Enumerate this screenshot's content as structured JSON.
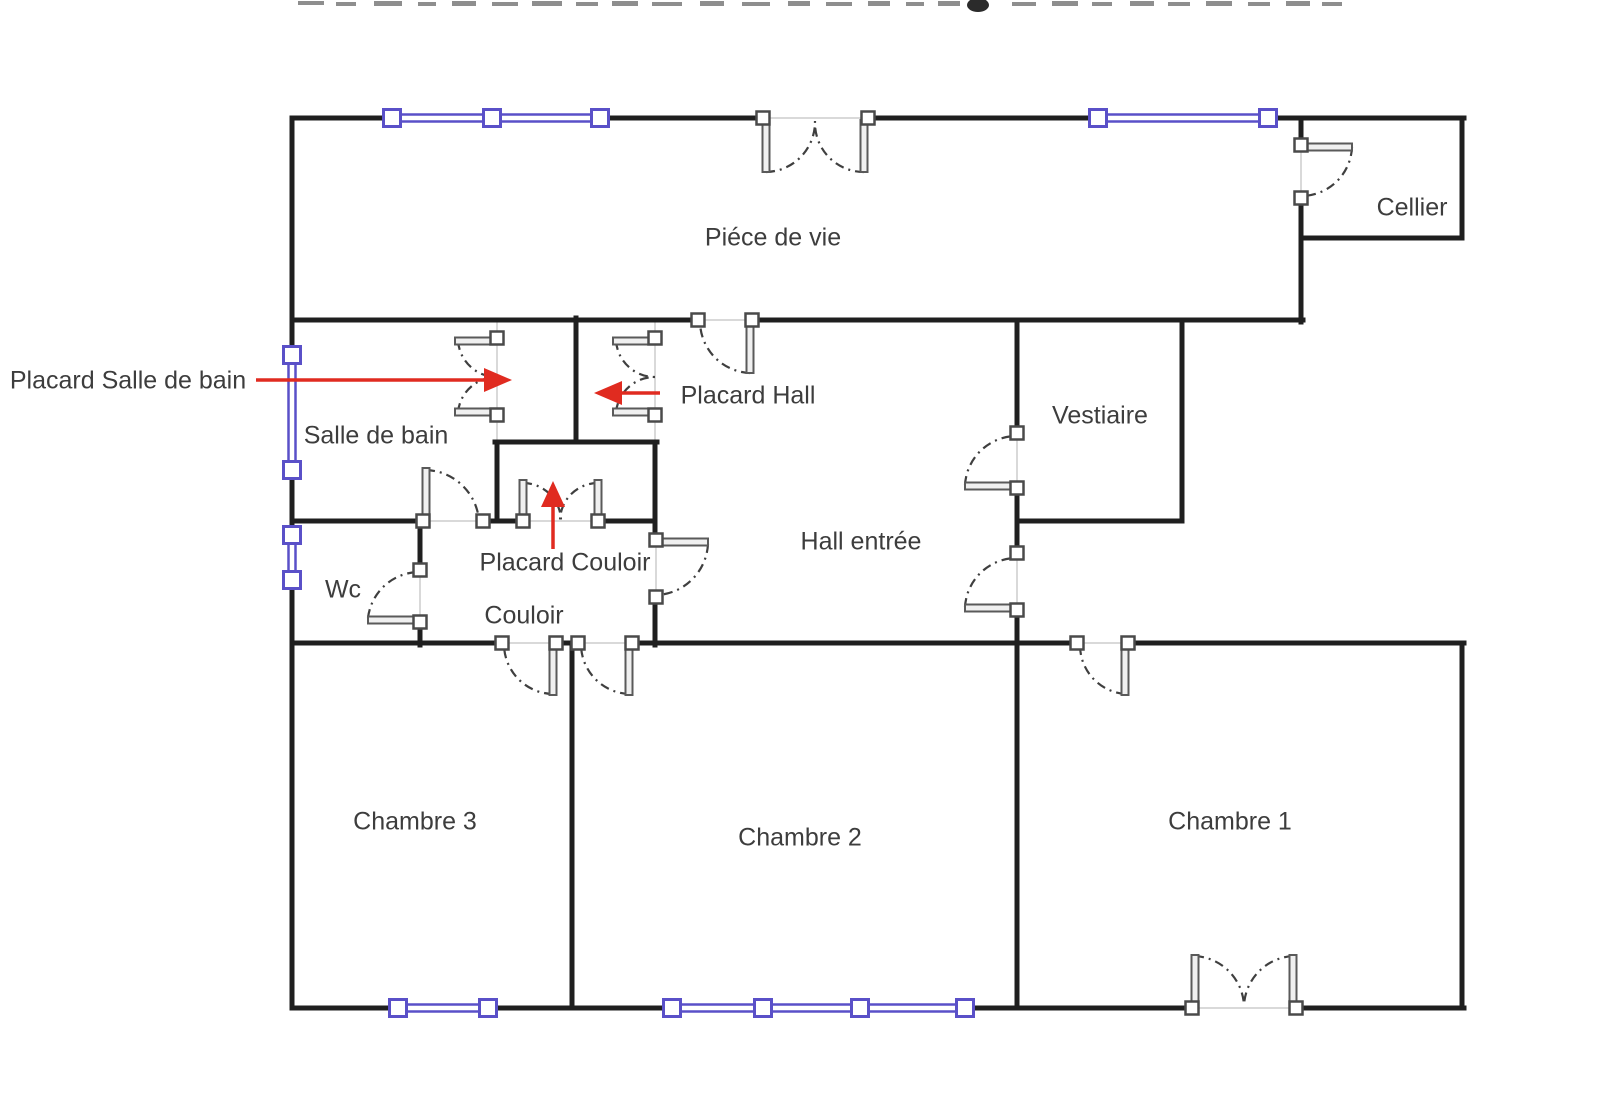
{
  "plan": {
    "rooms": [
      {
        "id": "piece-de-vie",
        "label": "Piéce de vie"
      },
      {
        "id": "cellier",
        "label": "Cellier"
      },
      {
        "id": "salle-de-bain",
        "label": "Salle de bain"
      },
      {
        "id": "vestiaire",
        "label": "Vestiaire"
      },
      {
        "id": "hall-entree",
        "label": "Hall entrée"
      },
      {
        "id": "wc",
        "label": "Wc"
      },
      {
        "id": "couloir",
        "label": "Couloir"
      },
      {
        "id": "chambre-3",
        "label": "Chambre 3"
      },
      {
        "id": "chambre-2",
        "label": "Chambre 2"
      },
      {
        "id": "chambre-1",
        "label": "Chambre 1"
      }
    ],
    "annotations": [
      {
        "id": "placard-salle-de-bain",
        "label": "Placard Salle de bain",
        "arrow_direction": "right"
      },
      {
        "id": "placard-hall",
        "label": "Placard Hall",
        "arrow_direction": "left"
      },
      {
        "id": "placard-couloir",
        "label": "Placard Couloir",
        "arrow_direction": "up"
      }
    ],
    "colors": {
      "wall": "#1f1f1f",
      "window": "#5a50c8",
      "door_panel": "#5a5a5a",
      "door_arc": "#3f3f3f",
      "opening": "#d9d9d9",
      "annotation_arrow": "#e02b20",
      "label_text": "#3d3d3d"
    }
  }
}
